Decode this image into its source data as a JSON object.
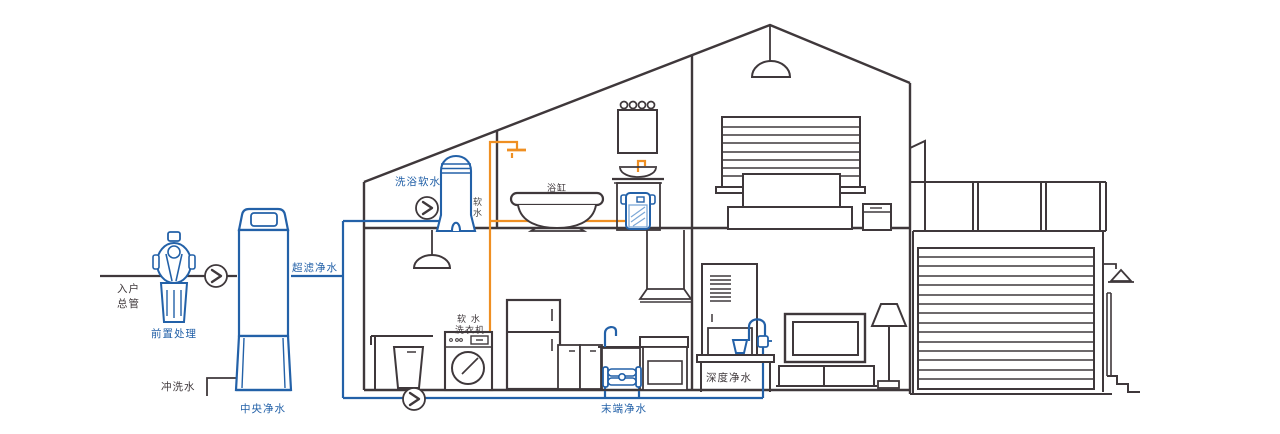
{
  "labels": {
    "entry": {
      "line1": "入户",
      "line2": "总管"
    },
    "pre_treatment": "前置处理",
    "flush_water": "冲洗水",
    "central_purifier": "中央净水",
    "ultrafiltration": "超滤净水",
    "bath_softener": "洗浴软水",
    "soft_water": {
      "char1": "软",
      "char2": "水"
    },
    "bathtub": "浴缸",
    "washer": {
      "line1": "软 水",
      "line2": "洗衣机"
    },
    "terminal_purifier": "末端净水",
    "deep_purifier": "深度净水"
  },
  "colors": {
    "pipe_blue": "#2361a8",
    "pipe_orange": "#ef8f22",
    "outline": "#3f383b",
    "background": "#ffffff"
  }
}
